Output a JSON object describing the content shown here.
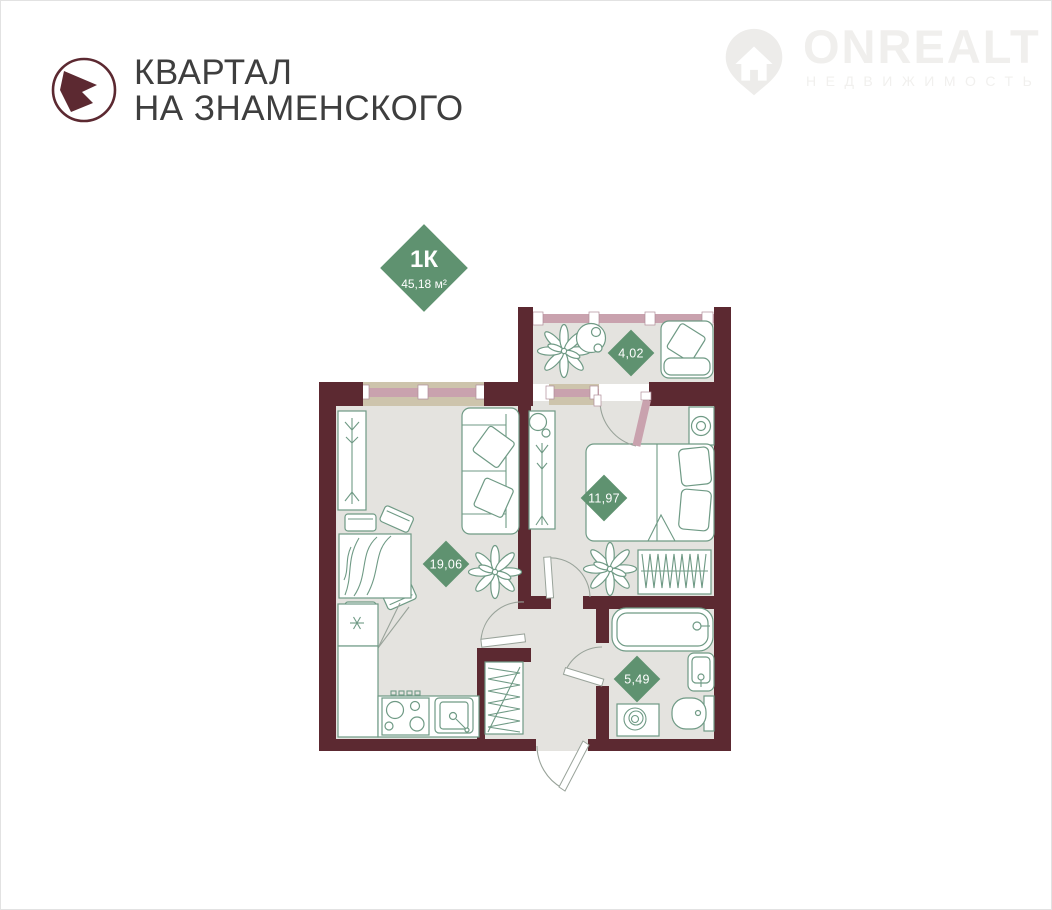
{
  "header": {
    "brand_line1": "КВАРТАЛ",
    "brand_line2": "НА ЗНАМЕНСКОГО"
  },
  "watermark": {
    "brand": "ONREALT",
    "tagline": "НЕДВИЖИМОСТЬ"
  },
  "unit_badge": {
    "type": "1К",
    "area": "45,18 м²"
  },
  "rooms": {
    "living_kitchen": {
      "area": "19,06"
    },
    "bedroom": {
      "area": "11,97"
    },
    "balcony": {
      "area": "4,02"
    },
    "bathroom": {
      "area": "5,49"
    }
  },
  "colors": {
    "wall": "#5c2931",
    "floor": "#e4e3df",
    "accent_green": "#5f9270",
    "window_pink": "#c9a2ae",
    "sill_tan": "#cdc4ac",
    "furniture_stroke": "#6f9a85",
    "title_text": "#3e3e3e",
    "watermark_gray": "#f0efed"
  }
}
